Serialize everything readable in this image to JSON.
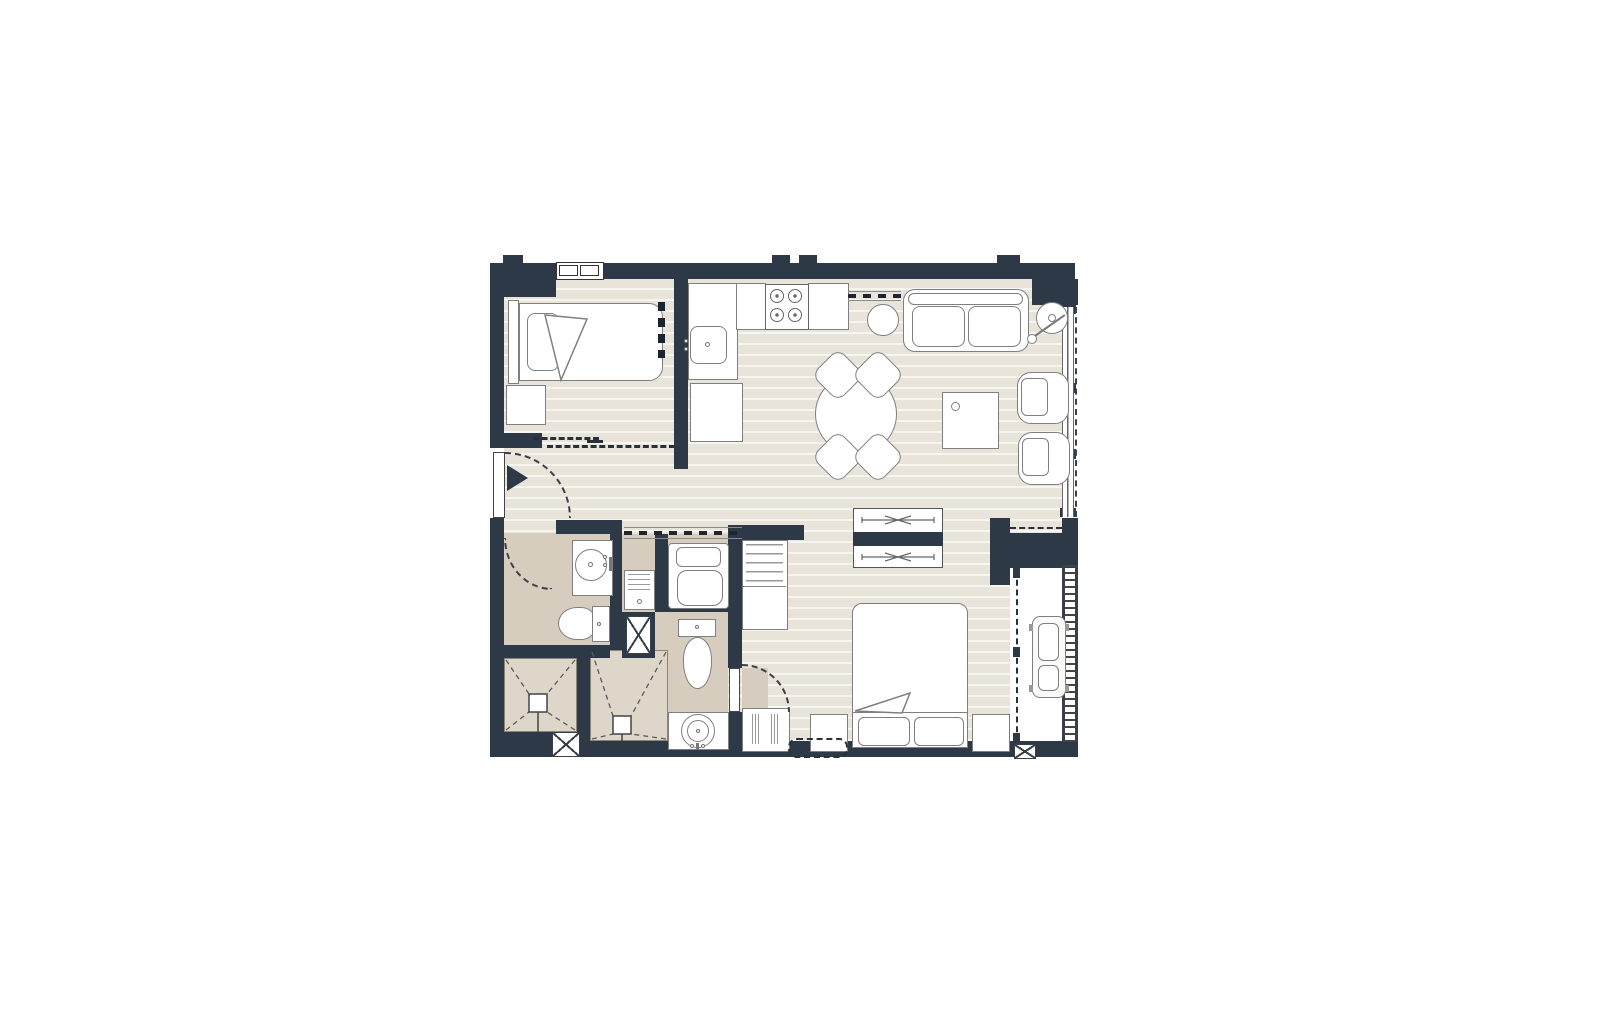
{
  "document": {
    "type": "architectural-floor-plan",
    "description": "One-bedroom apartment unit plan with open kitchen/living-dining area, two bathrooms with showers, laundry, master bedroom with wardrobe, and AC ledge/balcony",
    "text_labels": []
  },
  "colors": {
    "wall": "#2e3947",
    "floor_base": "#e9e4da",
    "floor_stripe": "#f7f5ef",
    "bath_floor": "#d6cdbe",
    "shower_floor": "#ded7c9",
    "line": "#7f7f7f",
    "dash": "#3a404a",
    "white": "#ffffff"
  },
  "rooms": [
    {
      "id": "bedroom-2",
      "furniture": [
        "single-bed",
        "headboard",
        "pillow",
        "blanket-fold",
        "nightstand",
        "dashed-wardrobe-strip",
        "sliding-door-dashed",
        "window"
      ]
    },
    {
      "id": "kitchen",
      "furniture": [
        "l-counter",
        "kitchen-sink",
        "cooktop-4-burner",
        "island-counter",
        "overhead-cabinet-dashed",
        "refrigerator"
      ]
    },
    {
      "id": "living-dining",
      "furniture": [
        "two-seat-sofa",
        "side-stool",
        "floor-lamp",
        "round-dining-table",
        "dining-chair-x4",
        "coffee-table",
        "armchair-x2",
        "sliding-glass-window"
      ]
    },
    {
      "id": "entry-hall",
      "furniture": [
        "entry-door-leaf",
        "entry-door-swing",
        "entry-direction-arrow"
      ]
    },
    {
      "id": "bathroom-1",
      "furniture": [
        "vanity-round-basin",
        "toilet",
        "door-swing",
        "shower-stall-with-drain"
      ]
    },
    {
      "id": "bathroom-2",
      "furniture": [
        "toilet",
        "vanity-round-basin",
        "door-swing",
        "shower-stall-with-drain"
      ]
    },
    {
      "id": "laundry-nook",
      "furniture": [
        "washing-machine",
        "laundry-basket",
        "duct-shaft-x",
        "sliding-track-dashed"
      ]
    },
    {
      "id": "master-bedroom",
      "furniture": [
        "double-bed",
        "pillow-x2",
        "blanket-fold",
        "nightstand-x2",
        "wardrobe-hanging-rails",
        "dresser",
        "wall-unit-dashed"
      ]
    },
    {
      "id": "balcony-ac-ledge",
      "furniture": [
        "ac-condenser-unit",
        "louver-screen",
        "access-panel-dashed",
        "duct-shaft-x"
      ]
    }
  ]
}
